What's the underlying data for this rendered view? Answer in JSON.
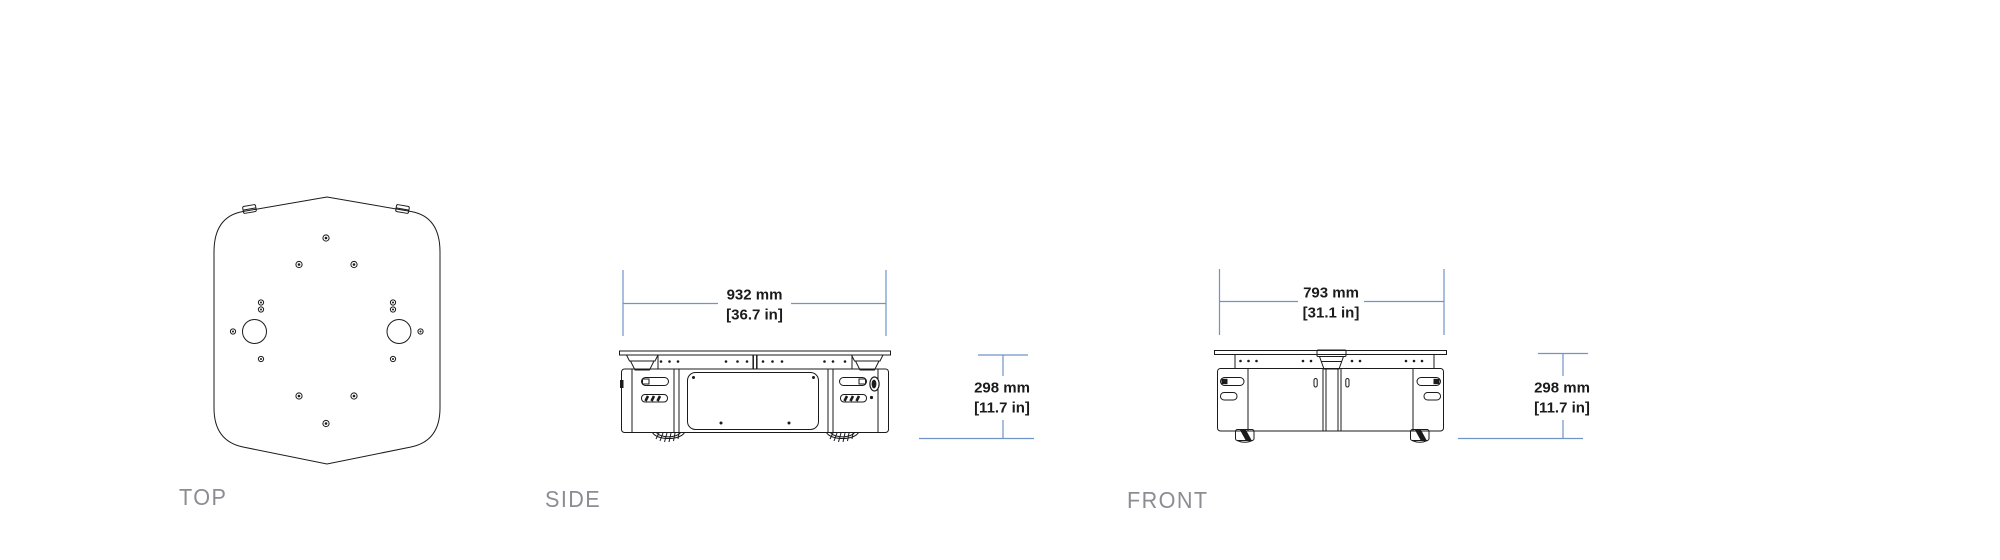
{
  "drawing": {
    "views": {
      "top": {
        "label": "TOP"
      },
      "side": {
        "label": "SIDE",
        "width": {
          "mm": "932 mm",
          "inches": "[36.7 in]"
        },
        "height": {
          "mm": "298 mm",
          "inches": "[11.7 in]"
        }
      },
      "front": {
        "label": "FRONT",
        "width": {
          "mm": "793 mm",
          "inches": "[31.1 in]"
        },
        "height": {
          "mm": "298 mm",
          "inches": "[11.7 in]"
        }
      }
    },
    "colors": {
      "line": "#1b1b1d",
      "dimension": "#6f94c6",
      "label": "#8c8c92",
      "background": "#ffffff"
    }
  }
}
